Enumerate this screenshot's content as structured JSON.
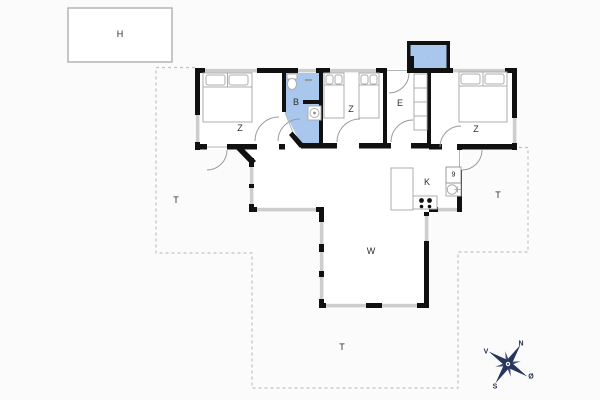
{
  "plan_type": "holiday-house-floor-plan",
  "outbuilding": {
    "label": "H"
  },
  "rooms": {
    "bedroom_left": "Z",
    "bathroom": "B",
    "bedroom_middle": "Z",
    "entrance": "E",
    "bedroom_right": "Z",
    "kitchen": "K",
    "utility_box": "9",
    "living_room": "W",
    "annex_mark": "·"
  },
  "terraces": {
    "west": "T",
    "east": "T",
    "south": "T"
  },
  "compass": {
    "north": "N",
    "east": "Ø",
    "south": "S",
    "west": "V"
  },
  "colors": {
    "background": "#fbfbfb",
    "wall": "#111111",
    "window": "#cdcdcd",
    "wet_room_fill": "#a9c7ec",
    "furniture_stroke": "#adadad",
    "terrace_dash": "#c2c2c2",
    "compass_rose": "#26355c"
  }
}
